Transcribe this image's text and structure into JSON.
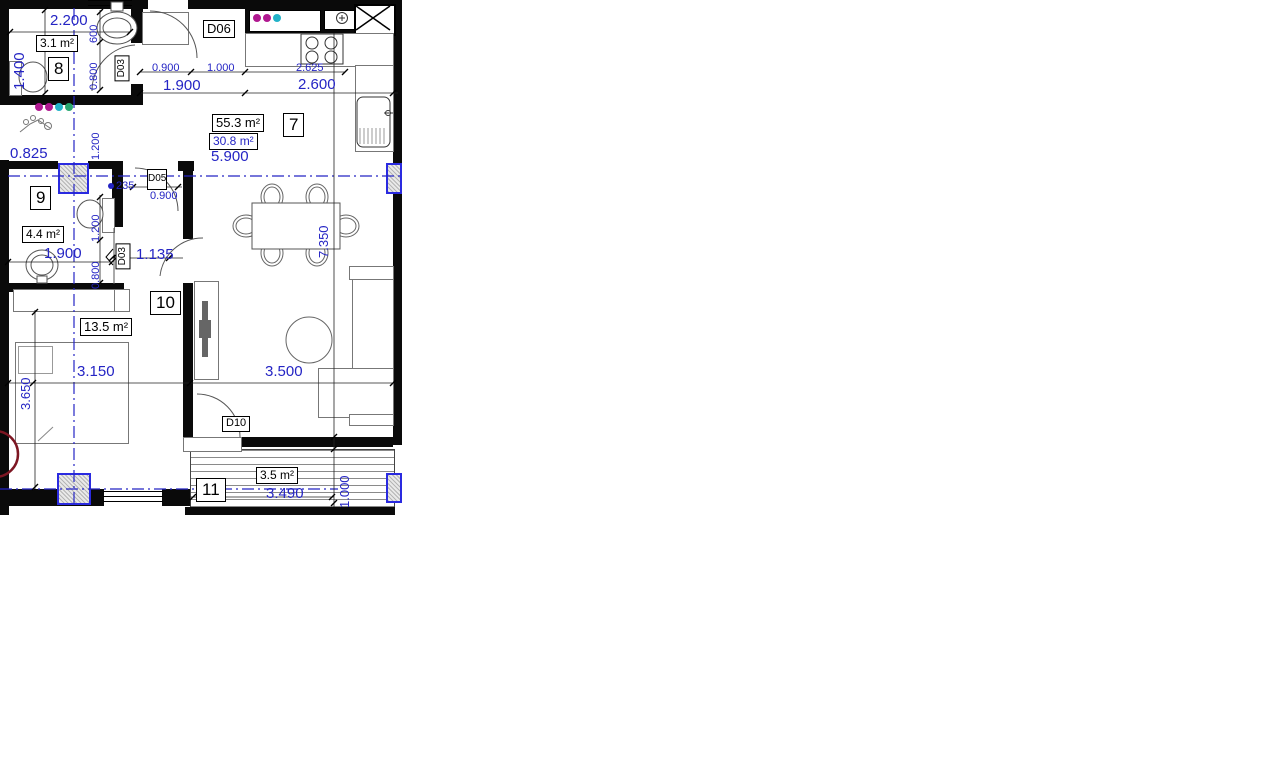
{
  "plan": {
    "rooms": {
      "r7": {
        "number": "7",
        "area_total": "55.3 m²",
        "area": "30.8 m²"
      },
      "r8": {
        "number": "8",
        "area": "3.1 m²"
      },
      "r9": {
        "number": "9",
        "area": "4.4 m²"
      },
      "r10": {
        "number": "10",
        "area": "13.5 m²"
      },
      "r11": {
        "number": "11",
        "area": "3.5 m²"
      }
    },
    "doors": {
      "d03_top": "D03",
      "d06": "D06",
      "d05": "D05",
      "d03_mid": "D03",
      "d10": "D10"
    },
    "dims": {
      "d2200": "2.200",
      "d1400": "1.400",
      "d600": "600",
      "d0800_top": "0.800",
      "d0900_top": "0.900",
      "d1000_top": "1.000",
      "d1900_top": "1.900",
      "d2625": "2.625",
      "d2600": "2.600",
      "d5900": "5.900",
      "d0825": "0.825",
      "d1200_niche": "1.200",
      "d235": "235",
      "d0900_d05": "0.900",
      "d1200_wc": "1.200",
      "d0800_mid": "0.800",
      "d1135": "1.135",
      "d1900_r9": "1.900",
      "d7350": "7.350",
      "d3150": "3.150",
      "d3650": "3.650",
      "d3500": "3.500",
      "d3490": "3.490",
      "d1000_balc": "1.000"
    },
    "colors": {
      "dimension_blue": "#2424c4",
      "wall_black": "#0a0a0a",
      "column_border_blue": "#2a2ae0",
      "marker_magenta": "#b01890",
      "marker_cyan": "#22b2c8",
      "marker_green": "#28a870",
      "grid_bubble_red": "#7d1622"
    }
  }
}
